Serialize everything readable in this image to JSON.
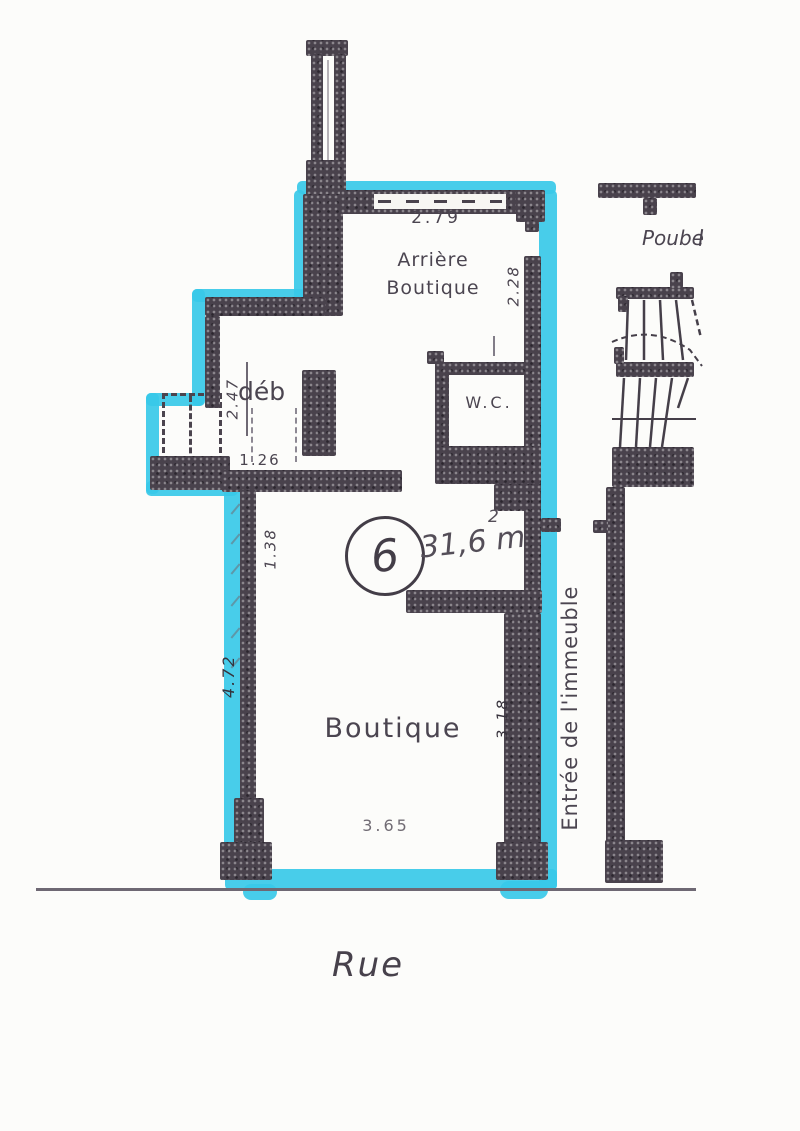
{
  "plan": {
    "unit_number": "6",
    "area": {
      "value": "31,6 m",
      "exponent": "2"
    },
    "rooms": {
      "arriere_line1": "Arrière",
      "arriere_line2": "Boutique",
      "deb": "déb",
      "wc": "W.C.",
      "boutique": "Boutique",
      "entree_immeuble": "Entrée de l'immeuble",
      "poubelles": "Poube",
      "rue": "Rue"
    },
    "dimensions": {
      "arriere_width": "2.79",
      "arriere_depth": "2.28",
      "deb_depth": "2.47",
      "deb_width": "1.26",
      "boutique_upper_left": "1.38",
      "boutique_left": "4.72",
      "boutique_right": "3.18",
      "storefront_width": "3.65"
    },
    "colors": {
      "highlighter": "#38c9e8",
      "wall": "#49424c",
      "ink": "#4b4550"
    }
  }
}
